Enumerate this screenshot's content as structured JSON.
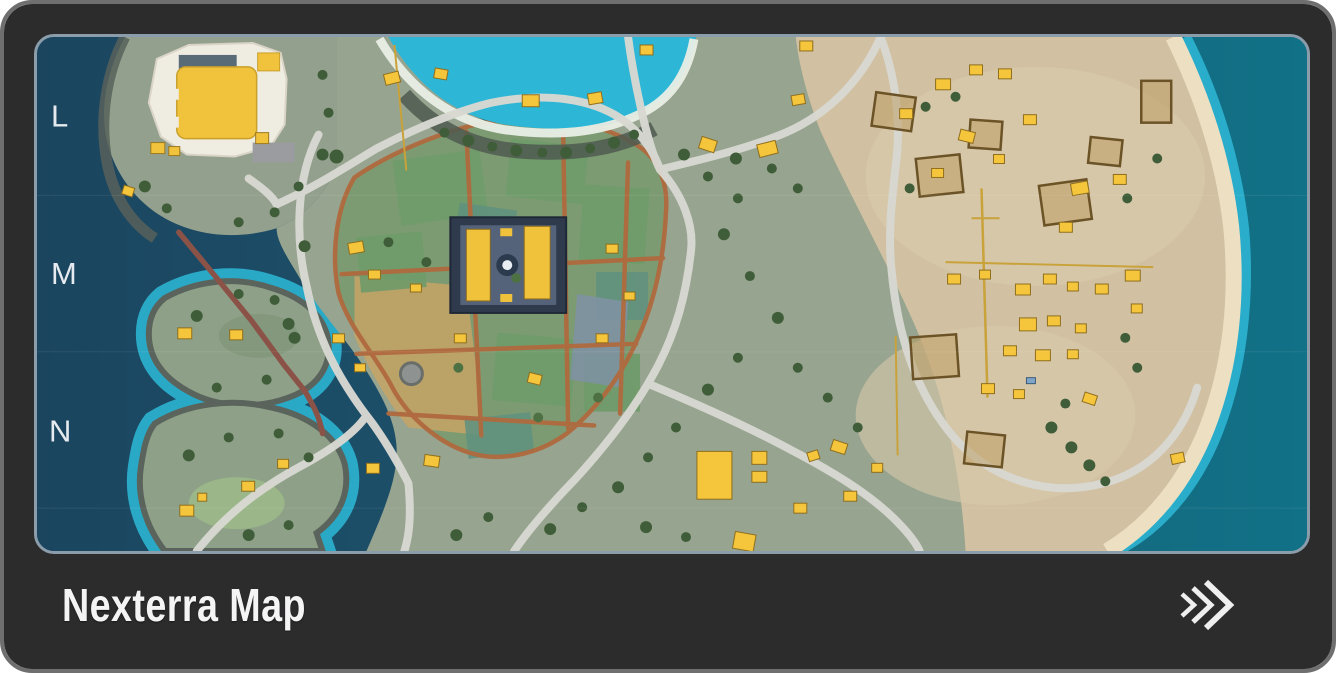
{
  "card": {
    "title": "Nexterra Map",
    "action": {
      "icon": "fast-forward-chevrons-icon"
    }
  },
  "map": {
    "name": "Nexterra Map",
    "grid_labels": [
      "L",
      "M",
      "N"
    ],
    "colors": {
      "frame_rim": "#6f6f6f",
      "card_bg": "#2d2c2d",
      "map_border": "#8b9dab",
      "ocean_deep": "#1b455f",
      "ocean_teal": "#117187",
      "shallow_water": "#2db6d6",
      "land": "#93a08d",
      "sand": "#d3c2a2",
      "beach": "#ecdfc2",
      "farm_green": "#7d9b72",
      "farm_path": "#b06a3e",
      "road": "#d8d8d2",
      "building_yellow": "#f5c63c",
      "rope_bridge": "#8b5348"
    }
  }
}
